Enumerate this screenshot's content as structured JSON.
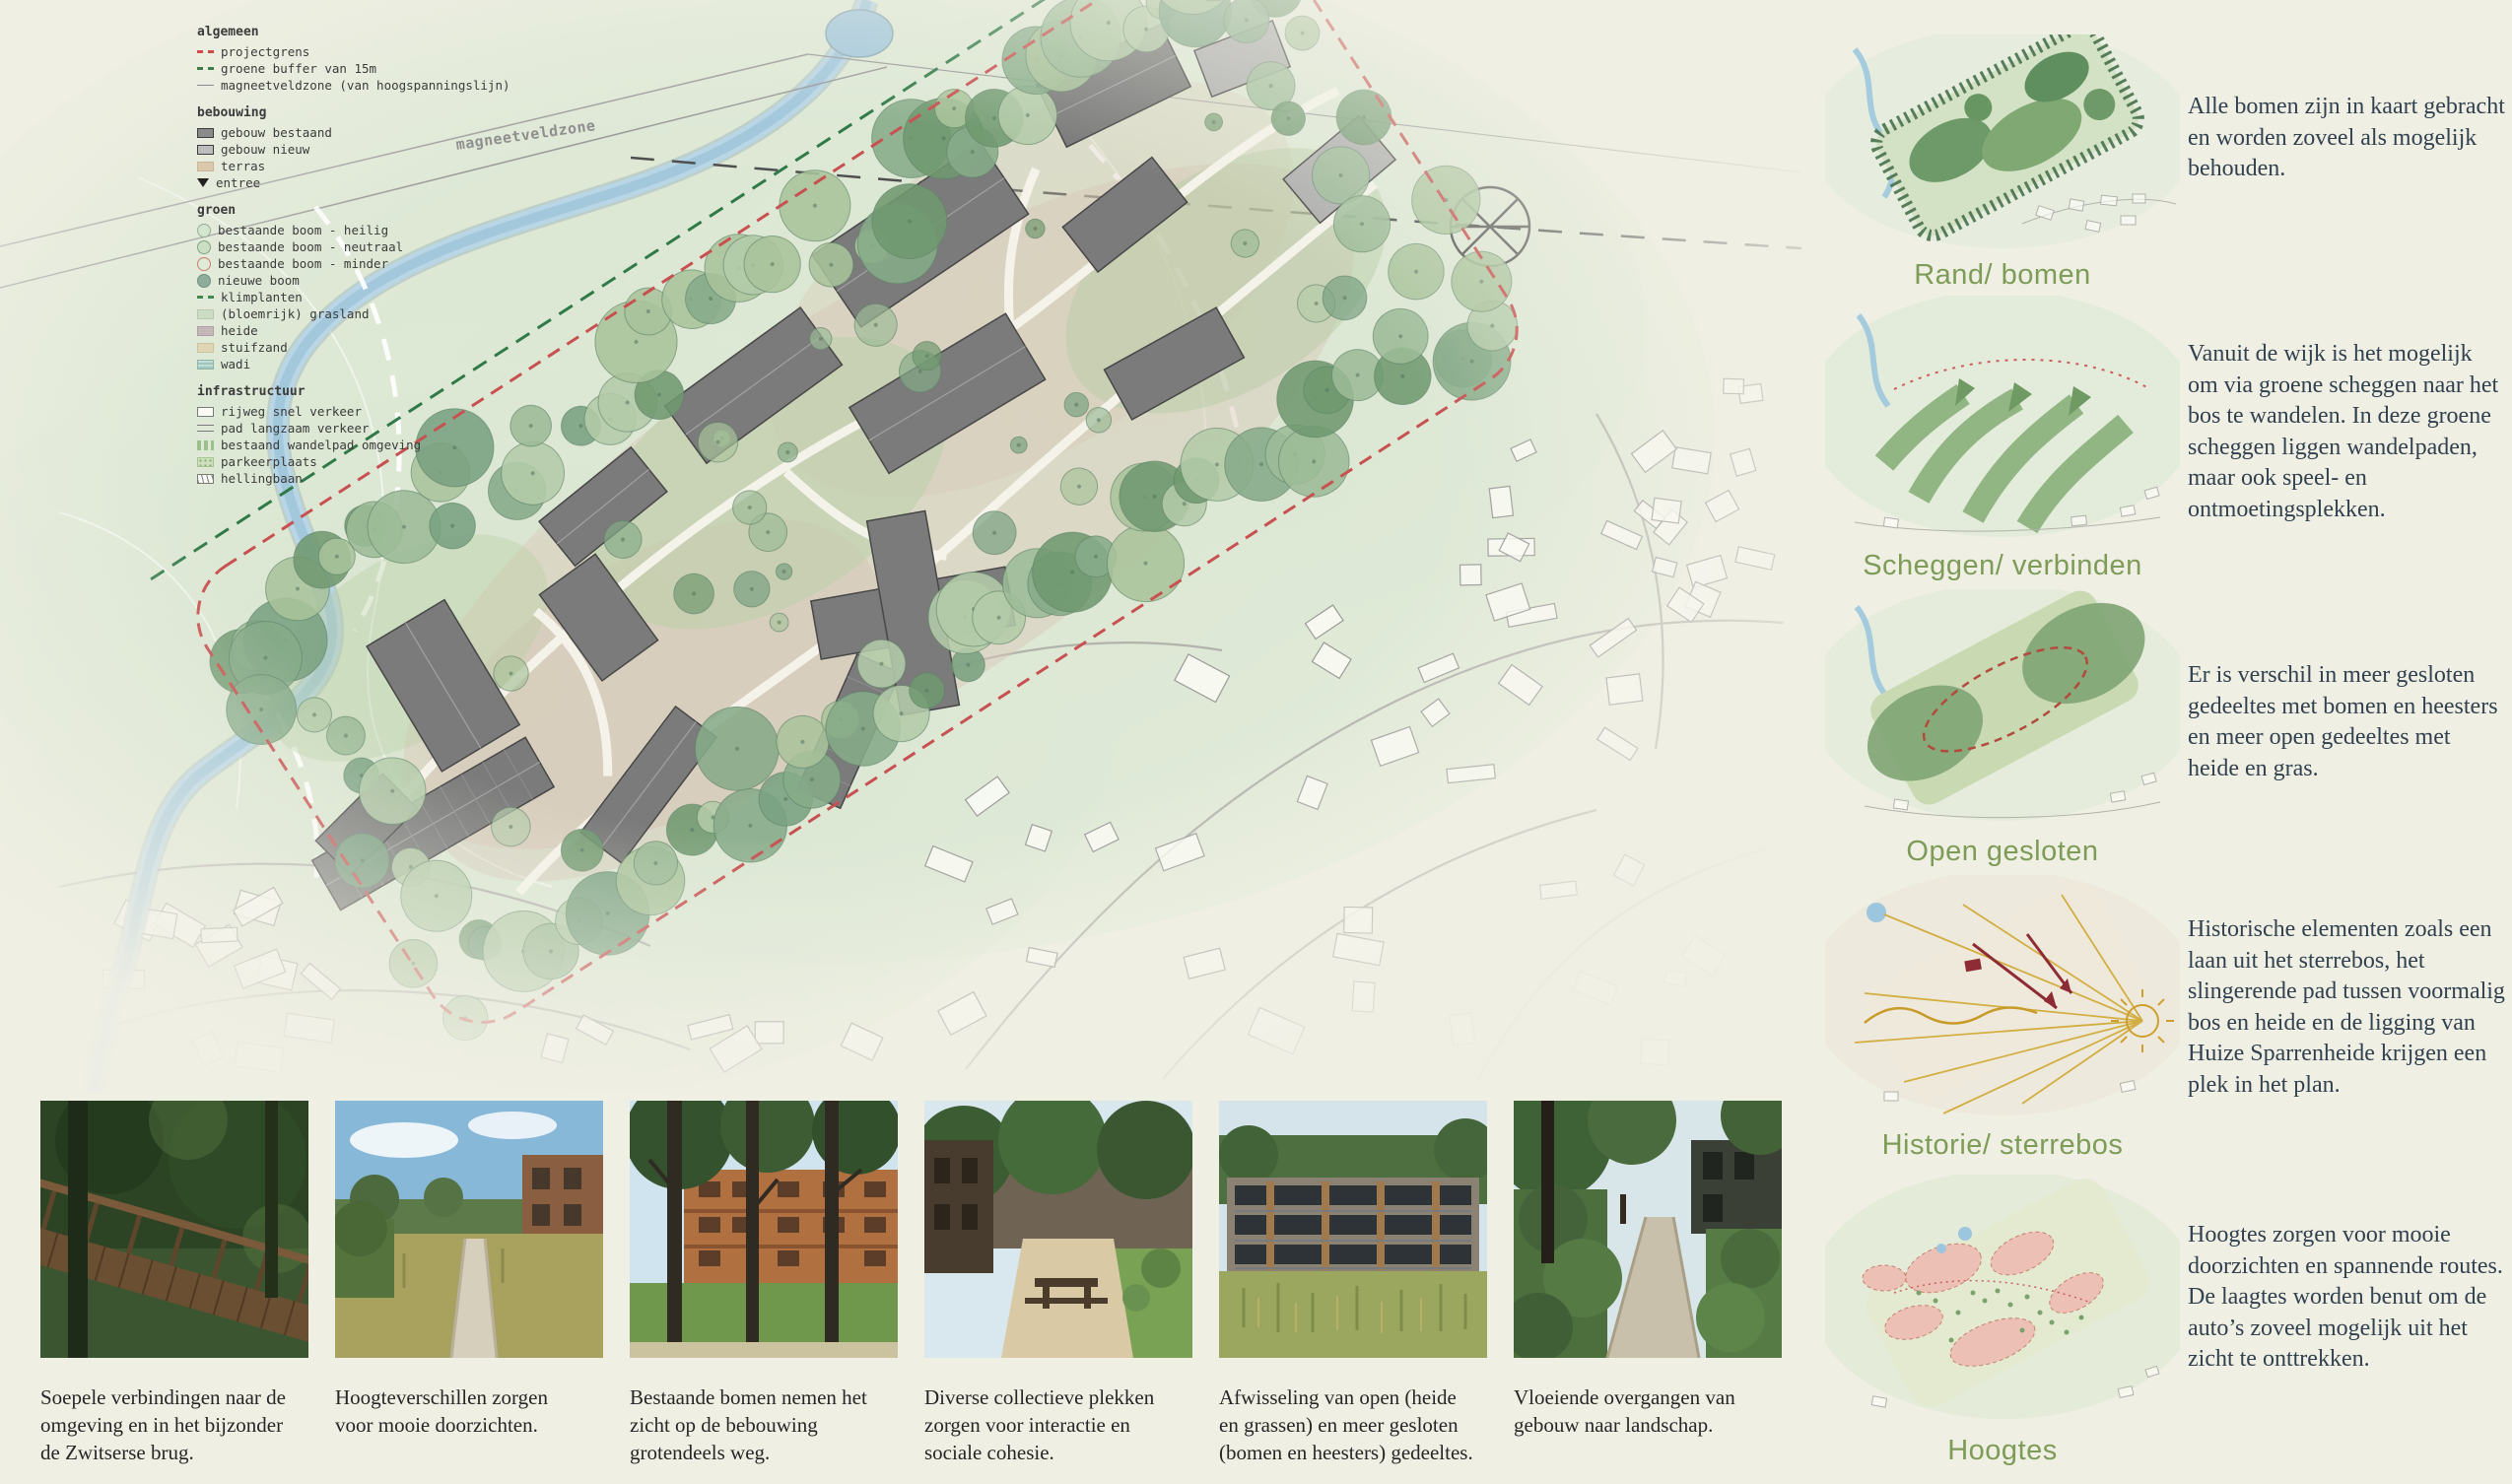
{
  "colors": {
    "background": "#f0efe4",
    "accent_green_label": "#7d9c58",
    "panel_text": "#31414f",
    "legend_text": "#3b3b3b",
    "projectgrens_red": "#cf4a4a",
    "buffer_green": "#3a7d4a"
  },
  "map": {
    "zone_label": "magneetveldzone"
  },
  "legend": {
    "sections": [
      {
        "title": "algemeen",
        "items": [
          {
            "label": "projectgrens"
          },
          {
            "label": "groene buffer van 15m"
          },
          {
            "label": "magneetveldzone (van hoogspanningslijn)"
          }
        ]
      },
      {
        "title": "bebouwing",
        "items": [
          {
            "label": "gebouw bestaand"
          },
          {
            "label": "gebouw nieuw"
          },
          {
            "label": "terras"
          },
          {
            "label": "entree"
          }
        ]
      },
      {
        "title": "groen",
        "items": [
          {
            "label": "bestaande boom - heilig"
          },
          {
            "label": "bestaande boom - neutraal"
          },
          {
            "label": "bestaande boom - minder"
          },
          {
            "label": "nieuwe boom"
          },
          {
            "label": "klimplanten"
          },
          {
            "label": "(bloemrijk) grasland"
          },
          {
            "label": "heide"
          },
          {
            "label": "stuifzand"
          },
          {
            "label": "wadi"
          }
        ]
      },
      {
        "title": "infrastructuur",
        "items": [
          {
            "label": "rijweg snel verkeer"
          },
          {
            "label": "pad langzaam verkeer"
          },
          {
            "label": "bestaand wandelpad omgeving"
          },
          {
            "label": "parkeerplaats"
          },
          {
            "label": "hellingbaan"
          }
        ]
      }
    ]
  },
  "panels": [
    {
      "label": "Rand/ bomen",
      "text": "Alle bomen zijn in kaart gebracht en worden zoveel als mogelijk behouden."
    },
    {
      "label": "Scheggen/ verbinden",
      "text": "Vanuit de wijk is het mogelijk om via groene scheggen naar het bos te wandelen. In deze groene scheggen liggen wandelpaden, maar ook speel- en ontmoetingsplekken."
    },
    {
      "label": "Open gesloten",
      "text": "Er is verschil in meer gesloten gedeeltes met bomen en heesters en meer open gedeeltes met heide en gras."
    },
    {
      "label": "Historie/ sterrebos",
      "text": "Historische elementen zoals een laan uit het sterrebos, het slingerende pad tussen voormalig bos en heide en de ligging van Huize Sparrenheide krijgen een plek in het plan."
    },
    {
      "label": "Hoogtes",
      "text": "Hoogtes zorgen voor mooie doorzichten en spannende routes. De laagtes worden benut om de auto’s zoveel mogelijk uit het zicht te onttrekken."
    }
  ],
  "photos": [
    {
      "caption": "Soepele verbindingen naar de omgeving en in het bijzonder de Zwitserse brug."
    },
    {
      "caption": "Hoogteverschillen zorgen voor mooie doorzichten."
    },
    {
      "caption": "Bestaande bomen nemen het zicht op de bebouwing grotendeels weg."
    },
    {
      "caption": "Diverse collectieve plekken zorgen voor interactie en sociale cohesie."
    },
    {
      "caption": "Afwisseling van open (heide en grassen) en meer gesloten (bomen en heesters) gedeeltes."
    },
    {
      "caption": "Vloeiende overgangen van gebouw naar landschap."
    }
  ]
}
